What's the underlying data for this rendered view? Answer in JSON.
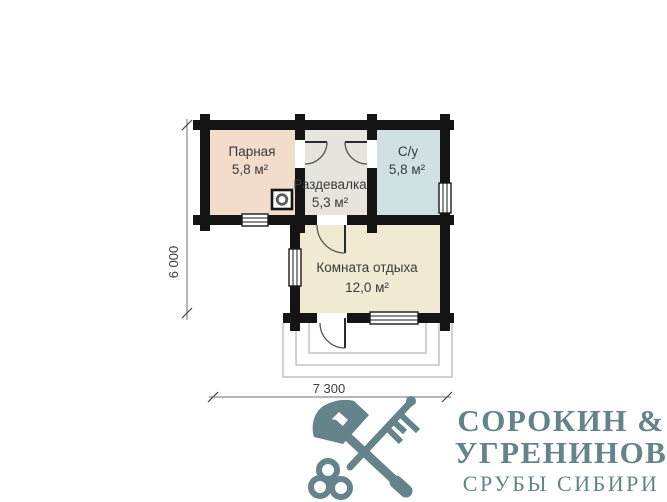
{
  "theme": {
    "wall": "#141414",
    "line": "#6f6f6f",
    "text": "#3a3a3a",
    "logo": "#64838a"
  },
  "plan": {
    "rooms": [
      {
        "name": "Парная",
        "area": "5,8 м²",
        "fill": "#f2ddcb"
      },
      {
        "name": "Раздевалка",
        "area": "5,3 м²",
        "fill": "#e6e4dc"
      },
      {
        "name": "С/у",
        "area": "5,8 м²",
        "fill": "#d0e1e4"
      },
      {
        "name": "Комната отдыха",
        "area": "12,0 м²",
        "fill": "#f0ead2"
      }
    ],
    "dimensions": {
      "height_label": "6 000",
      "width_label": "7 300"
    },
    "features": [
      "stove",
      "porch-steps",
      "4 windows",
      "4 doors"
    ]
  },
  "logo": {
    "line1": "СОРОКИН &",
    "line2": "УГРЕНИНОВ",
    "line3": "СРУБЫ СИБИРИ",
    "icon": "crossed-axe-and-key"
  }
}
